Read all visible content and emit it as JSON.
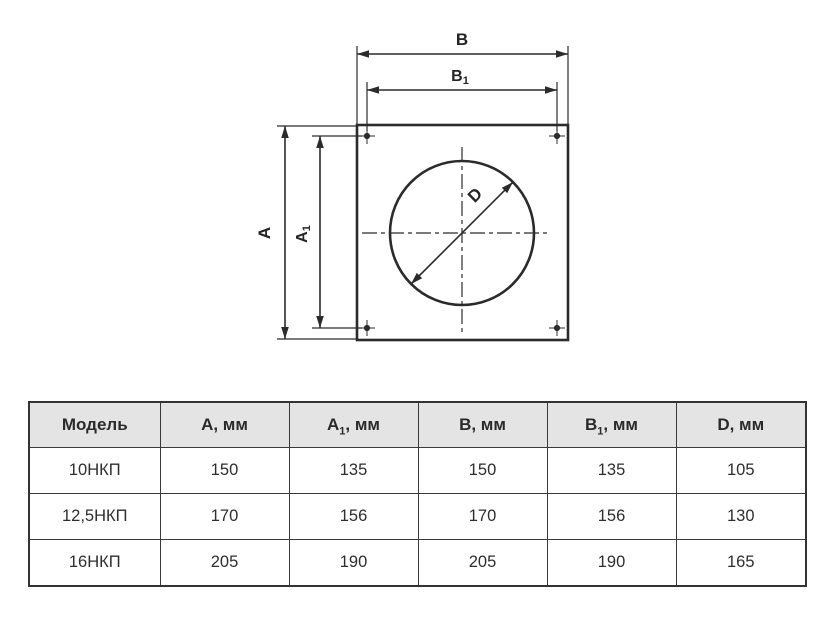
{
  "drawing": {
    "dim_b": {
      "label": "B"
    },
    "dim_b1": {
      "base": "B",
      "sub": "1"
    },
    "dim_a": {
      "label": "A"
    },
    "dim_a1": {
      "base": "A",
      "sub": "1"
    },
    "dim_d": {
      "label": "D"
    }
  },
  "table": {
    "headers": {
      "model": "Модель",
      "a": "А, мм",
      "a1": {
        "base": "А",
        "sub": "1",
        "unit": ", мм"
      },
      "b": "В, мм",
      "b1": {
        "base": "В",
        "sub": "1",
        "unit": ", мм"
      },
      "d": "D, мм"
    },
    "rows": [
      {
        "model": "10НКП",
        "a": "150",
        "a1": "135",
        "b": "150",
        "b1": "135",
        "d": "105"
      },
      {
        "model": "12,5НКП",
        "a": "170",
        "a1": "156",
        "b": "170",
        "b1": "156",
        "d": "130"
      },
      {
        "model": "16НКП",
        "a": "205",
        "a1": "190",
        "b": "205",
        "b1": "190",
        "d": "165"
      }
    ]
  },
  "colors": {
    "line": "#2b2b2b",
    "table_border": "#333333",
    "header_bg": "#e4e4e4",
    "text": "#222222"
  }
}
